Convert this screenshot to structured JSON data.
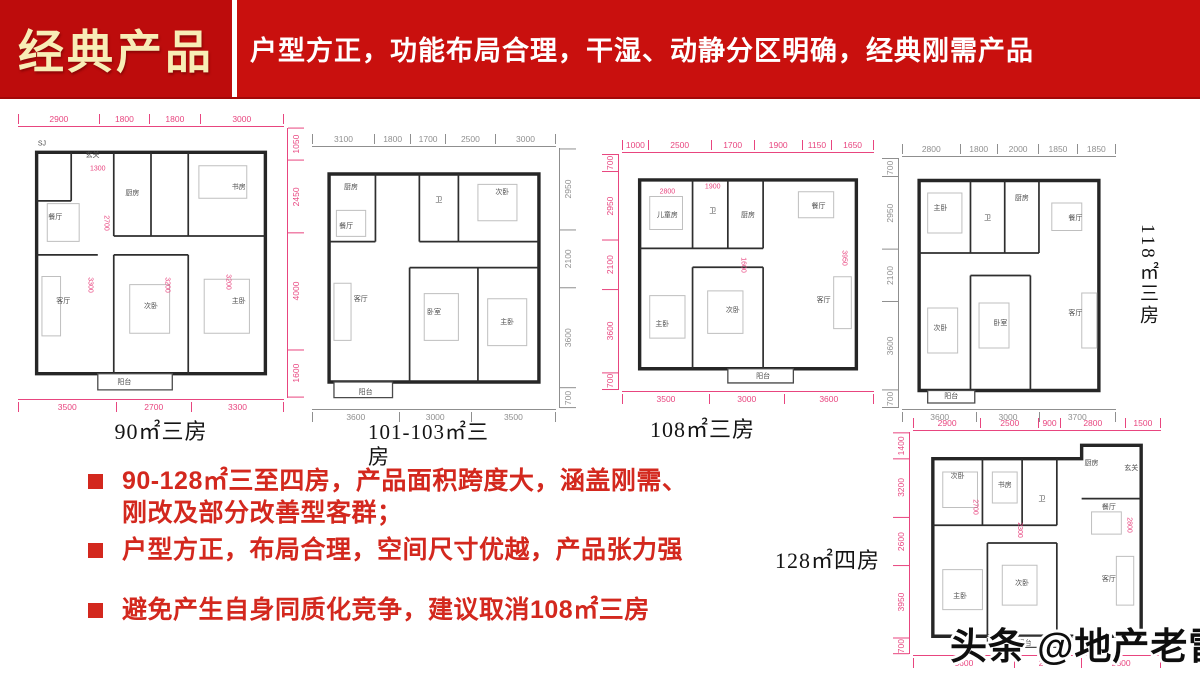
{
  "header": {
    "title": "经典产品",
    "subtitle": "户型方正，功能布局合理，干湿、动静分区明确，经典刚需产品",
    "banner_color": "#c9100e",
    "title_box_color": "#bd0c0c",
    "title_color": "#f8edb6",
    "subtitle_color": "#ffffff"
  },
  "bullets": {
    "marker_color": "#d3281e",
    "text_color": "#d3281e",
    "items": [
      "90-128㎡三至四房，产品面积跨度大，涵盖刚需、刚改及部分改善型客群；",
      "户型方正，布局合理，空间尺寸优越，产品张力强",
      "避免产生自身同质化竞争，建议取消108㎡三房"
    ]
  },
  "watermark": {
    "text": "头条 @地产老雷"
  },
  "plans": [
    {
      "label": "90㎡三房",
      "accent": "#e8457f",
      "side": "right",
      "dims_top": [
        "2900",
        "1800",
        "1800",
        "3000"
      ],
      "dims_side": [
        "1050",
        "2450",
        "4000",
        "1600"
      ],
      "dims_bottom": [
        "3500",
        "2700",
        "3300"
      ],
      "rooms": [
        {
          "n": "SJ",
          "x": 9,
          "y": 6
        },
        {
          "n": "玄关",
          "x": 28,
          "y": 10
        },
        {
          "n": "厨房",
          "x": 43,
          "y": 24
        },
        {
          "n": "书房",
          "x": 83,
          "y": 22
        },
        {
          "n": "餐厅",
          "x": 14,
          "y": 33
        },
        {
          "n": "客厅",
          "x": 17,
          "y": 64
        },
        {
          "n": "次卧",
          "x": 50,
          "y": 66
        },
        {
          "n": "主卧",
          "x": 83,
          "y": 64
        },
        {
          "n": "阳台",
          "x": 40,
          "y": 94
        }
      ],
      "inner_dims": [
        {
          "t": "1300",
          "x": 30,
          "y": 15
        },
        {
          "t": "2700",
          "x": 33,
          "y": 35,
          "v": true
        },
        {
          "t": "3300",
          "x": 27,
          "y": 58,
          "v": true
        },
        {
          "t": "3200",
          "x": 56,
          "y": 58,
          "v": true
        },
        {
          "t": "3200",
          "x": 79,
          "y": 57,
          "v": true
        }
      ]
    },
    {
      "label": "101-103㎡三房",
      "accent": "#8f8f8f",
      "side": "right",
      "dims_top": [
        "3100",
        "1800",
        "1700",
        "2500",
        "3000"
      ],
      "dims_side": [
        "2950",
        "2100",
        "3600",
        "700"
      ],
      "dims_bottom": [
        "3600",
        "3000",
        "3500"
      ],
      "rooms": [
        {
          "n": "厨房",
          "x": 16,
          "y": 15
        },
        {
          "n": "餐厅",
          "x": 14,
          "y": 30
        },
        {
          "n": "卫",
          "x": 52,
          "y": 20
        },
        {
          "n": "次卧",
          "x": 78,
          "y": 17
        },
        {
          "n": "客厅",
          "x": 20,
          "y": 58
        },
        {
          "n": "卧室",
          "x": 50,
          "y": 63
        },
        {
          "n": "主卧",
          "x": 80,
          "y": 67
        },
        {
          "n": "阳台",
          "x": 22,
          "y": 94
        }
      ],
      "inner_dims": []
    },
    {
      "label": "108㎡三房",
      "accent": "#e8457f",
      "side": "left",
      "dims_top": [
        "1000",
        "2500",
        "1700",
        "1900",
        "1150",
        "1650"
      ],
      "dims_side": [
        "700",
        "2950",
        "2100",
        "3600",
        "700"
      ],
      "dims_bottom": [
        "3500",
        "3000",
        "3600"
      ],
      "rooms": [
        {
          "n": "儿童房",
          "x": 18,
          "y": 26
        },
        {
          "n": "卫",
          "x": 36,
          "y": 24
        },
        {
          "n": "厨房",
          "x": 50,
          "y": 26
        },
        {
          "n": "餐厅",
          "x": 78,
          "y": 22
        },
        {
          "n": "主卧",
          "x": 16,
          "y": 72
        },
        {
          "n": "次卧",
          "x": 44,
          "y": 66
        },
        {
          "n": "客厅",
          "x": 80,
          "y": 62
        },
        {
          "n": "阳台",
          "x": 56,
          "y": 94
        }
      ],
      "inner_dims": [
        {
          "t": "2800",
          "x": 18,
          "y": 16
        },
        {
          "t": "1900",
          "x": 36,
          "y": 14
        },
        {
          "t": "1600",
          "x": 48,
          "y": 47,
          "v": true
        },
        {
          "t": "3950",
          "x": 88,
          "y": 44,
          "v": true
        }
      ]
    },
    {
      "label": "118㎡三房",
      "accent": "#8f8f8f",
      "side": "left",
      "dims_top": [
        "2800",
        "1800",
        "2000",
        "1850",
        "1850"
      ],
      "dims_side": [
        "700",
        "2950",
        "2100",
        "3600",
        "700"
      ],
      "dims_bottom": [
        "3600",
        "3000",
        "3700"
      ],
      "rooms": [
        {
          "n": "主卧",
          "x": 18,
          "y": 20
        },
        {
          "n": "卫",
          "x": 40,
          "y": 24
        },
        {
          "n": "厨房",
          "x": 56,
          "y": 16
        },
        {
          "n": "餐厅",
          "x": 81,
          "y": 24
        },
        {
          "n": "次卧",
          "x": 18,
          "y": 68
        },
        {
          "n": "卧室",
          "x": 46,
          "y": 66
        },
        {
          "n": "客厅",
          "x": 81,
          "y": 62
        },
        {
          "n": "阳台",
          "x": 23,
          "y": 95
        }
      ],
      "inner_dims": []
    },
    {
      "label": "128㎡四房",
      "accent": "#e8457f",
      "side": "left",
      "dims_top": [
        "2900",
        "2500",
        "900",
        "2800",
        "1500"
      ],
      "dims_side": [
        "1400",
        "3200",
        "2600",
        "3950",
        "700"
      ],
      "dims_bottom": [
        "3600",
        "2400",
        "2800"
      ],
      "rooms": [
        {
          "n": "次卧",
          "x": 18,
          "y": 20
        },
        {
          "n": "书房",
          "x": 37,
          "y": 24
        },
        {
          "n": "卫",
          "x": 52,
          "y": 30
        },
        {
          "n": "厨房",
          "x": 72,
          "y": 14
        },
        {
          "n": "玄关",
          "x": 88,
          "y": 16
        },
        {
          "n": "餐厅",
          "x": 79,
          "y": 34
        },
        {
          "n": "主卧",
          "x": 19,
          "y": 74
        },
        {
          "n": "次卧",
          "x": 44,
          "y": 68
        },
        {
          "n": "客厅",
          "x": 79,
          "y": 66
        },
        {
          "n": "阳台",
          "x": 45,
          "y": 95
        }
      ],
      "inner_dims": [
        {
          "t": "2700",
          "x": 25,
          "y": 34,
          "v": true
        },
        {
          "t": "2300",
          "x": 43,
          "y": 44,
          "v": true
        },
        {
          "t": "2800",
          "x": 87,
          "y": 42,
          "v": true
        }
      ]
    }
  ]
}
